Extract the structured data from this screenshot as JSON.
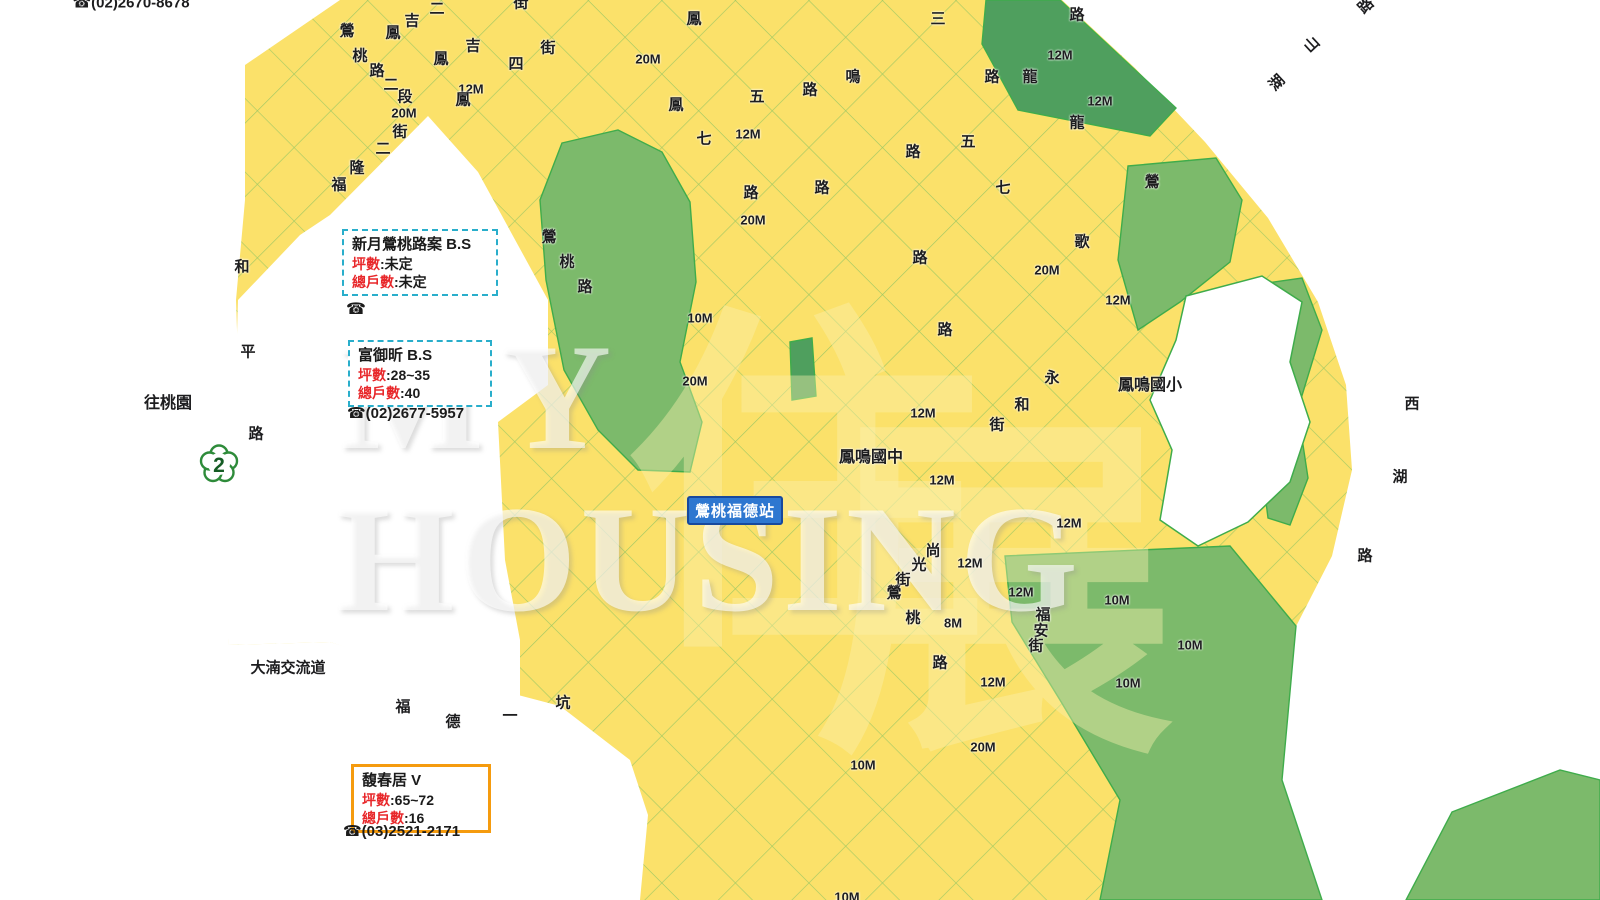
{
  "watermark": {
    "line1": "MY",
    "line2": "HOUSING",
    "cjk1": "住",
    "cjk2": "展"
  },
  "top_contact_phone": "☎(02)2670-8678",
  "projects": [
    {
      "name": "新月鶯桃路案 B.S",
      "fields": [
        {
          "label": "坪數",
          "value": "未定"
        },
        {
          "label": "總戶數",
          "value": "未定"
        }
      ],
      "phone": "☎"
    },
    {
      "name": "富御昕 B.S",
      "fields": [
        {
          "label": "坪數",
          "value": "28~35"
        },
        {
          "label": "總戶數",
          "value": "40"
        }
      ],
      "phone": "☎(02)2677-5957"
    },
    {
      "name": "馥春居 V",
      "fields": [
        {
          "label": "坪數",
          "value": "65~72"
        },
        {
          "label": "總戶數",
          "value": "16"
        }
      ],
      "phone": "☎(03)2521-2171"
    }
  ],
  "station": {
    "label": "鶯桃福德站"
  },
  "road_shield": {
    "number": "2"
  },
  "colors": {
    "residential_yellow": "#FBE16A",
    "park_green": "#7CBA6B",
    "dark_green": "#4F9F5E",
    "village_brown": "#8A7E6C",
    "commercial_red": "#DD5244",
    "school_salmon": "#EC8870",
    "pink": "#F3BDBB",
    "magenta": "#D63D9E",
    "lavender": "#C9C7E9",
    "teal_park": "#2AA678",
    "mrt_blue": "#2173D2",
    "planned_cyan": "#2FB7D8",
    "highway_orange": "#F59B0E",
    "railway_black": "#141414",
    "road_edge_green": "#3FAC4B",
    "station_blue": "#2E77D0",
    "info_red_text": "#E8282B",
    "highlight_road_yellow": "#EFF000"
  },
  "map_labels": [
    {
      "t": "☎(02)2670-8678",
      "x": 131,
      "y": 3,
      "s": 15,
      "n": "contact-phone-top"
    },
    {
      "t": "鶯",
      "x": 347,
      "y": 31
    },
    {
      "t": "桃",
      "x": 360,
      "y": 56
    },
    {
      "t": "路",
      "x": 377,
      "y": 71
    },
    {
      "t": "二",
      "x": 391,
      "y": 85
    },
    {
      "t": "段",
      "x": 405,
      "y": 97
    },
    {
      "t": "20M",
      "x": 404,
      "y": 113,
      "s": 13
    },
    {
      "t": "12M",
      "x": 471,
      "y": 89,
      "s": 13
    },
    {
      "t": "鳳",
      "x": 393,
      "y": 33
    },
    {
      "t": "吉",
      "x": 412,
      "y": 21
    },
    {
      "t": "二",
      "x": 437,
      "y": 9
    },
    {
      "t": "街",
      "x": 521,
      "y": 3
    },
    {
      "t": "鳳",
      "x": 441,
      "y": 59
    },
    {
      "t": "吉",
      "x": 473,
      "y": 46
    },
    {
      "t": "四",
      "x": 516,
      "y": 64
    },
    {
      "t": "街",
      "x": 548,
      "y": 48
    },
    {
      "t": "鳳",
      "x": 463,
      "y": 100
    },
    {
      "t": "福",
      "x": 339,
      "y": 185
    },
    {
      "t": "隆",
      "x": 357,
      "y": 168
    },
    {
      "t": "二",
      "x": 383,
      "y": 149
    },
    {
      "t": "街",
      "x": 400,
      "y": 132
    },
    {
      "t": "和",
      "x": 242,
      "y": 267
    },
    {
      "t": "平",
      "x": 248,
      "y": 352
    },
    {
      "t": "路",
      "x": 256,
      "y": 434
    },
    {
      "t": "往桃園",
      "x": 168,
      "y": 404,
      "s": 16,
      "n": "to-taoyuan-label"
    },
    {
      "t": "大湳交流道",
      "x": 288,
      "y": 668,
      "s": 15,
      "n": "danan-interchange-label"
    },
    {
      "t": "鳳",
      "x": 694,
      "y": 19
    },
    {
      "t": "五",
      "x": 757,
      "y": 97
    },
    {
      "t": "路",
      "x": 810,
      "y": 90
    },
    {
      "t": "鳳",
      "x": 676,
      "y": 105
    },
    {
      "t": "七",
      "x": 704,
      "y": 139
    },
    {
      "t": "路",
      "x": 751,
      "y": 193
    },
    {
      "t": "路",
      "x": 822,
      "y": 188
    },
    {
      "t": "20M",
      "x": 648,
      "y": 59,
      "s": 13
    },
    {
      "t": "12M",
      "x": 748,
      "y": 134,
      "s": 13
    },
    {
      "t": "鶯",
      "x": 549,
      "y": 237
    },
    {
      "t": "桃",
      "x": 567,
      "y": 262
    },
    {
      "t": "路",
      "x": 585,
      "y": 287
    },
    {
      "t": "20M",
      "x": 753,
      "y": 220,
      "s": 13
    },
    {
      "t": "10M",
      "x": 700,
      "y": 318,
      "s": 13
    },
    {
      "t": "20M",
      "x": 695,
      "y": 381,
      "s": 13
    },
    {
      "t": "鳴",
      "x": 853,
      "y": 77
    },
    {
      "t": "三",
      "x": 938,
      "y": 19
    },
    {
      "t": "路",
      "x": 1077,
      "y": 15
    },
    {
      "t": "路",
      "x": 992,
      "y": 77
    },
    {
      "t": "龍",
      "x": 1030,
      "y": 77
    },
    {
      "t": "五",
      "x": 968,
      "y": 142
    },
    {
      "t": "路",
      "x": 913,
      "y": 152
    },
    {
      "t": "七",
      "x": 1003,
      "y": 188
    },
    {
      "t": "龍",
      "x": 1077,
      "y": 123
    },
    {
      "t": "鶯",
      "x": 1152,
      "y": 182
    },
    {
      "t": "12M",
      "x": 1060,
      "y": 55,
      "s": 13
    },
    {
      "t": "12M",
      "x": 1100,
      "y": 101,
      "s": 13
    },
    {
      "t": "路",
      "x": 920,
      "y": 258
    },
    {
      "t": "歌",
      "x": 1082,
      "y": 242
    },
    {
      "t": "20M",
      "x": 1047,
      "y": 270,
      "s": 13
    },
    {
      "t": "12M",
      "x": 1118,
      "y": 300,
      "s": 13
    },
    {
      "t": "路",
      "x": 945,
      "y": 330
    },
    {
      "t": "湖",
      "x": 1277,
      "y": 83,
      "r": -43
    },
    {
      "t": "山",
      "x": 1312,
      "y": 45,
      "r": -43
    },
    {
      "t": "路",
      "x": 1366,
      "y": 6,
      "r": -43
    },
    {
      "t": "西",
      "x": 1412,
      "y": 404
    },
    {
      "t": "湖",
      "x": 1400,
      "y": 477
    },
    {
      "t": "路",
      "x": 1365,
      "y": 556
    },
    {
      "t": "永",
      "x": 1052,
      "y": 378
    },
    {
      "t": "和",
      "x": 1022,
      "y": 405
    },
    {
      "t": "街",
      "x": 997,
      "y": 425
    },
    {
      "t": "鳳鳴國小",
      "x": 1150,
      "y": 386,
      "s": 16,
      "n": "fengming-elementary-label"
    },
    {
      "t": "鳳鳴國中",
      "x": 871,
      "y": 458,
      "s": 16,
      "n": "fengming-junior-high-label"
    },
    {
      "t": "12M",
      "x": 923,
      "y": 413,
      "s": 13
    },
    {
      "t": "12M",
      "x": 942,
      "y": 480,
      "s": 13
    },
    {
      "t": "12M",
      "x": 1069,
      "y": 523,
      "s": 13
    },
    {
      "t": "12M",
      "x": 970,
      "y": 563,
      "s": 13
    },
    {
      "t": "8M",
      "x": 953,
      "y": 623,
      "s": 13
    },
    {
      "t": "12M",
      "x": 1021,
      "y": 592,
      "s": 13
    },
    {
      "t": "12M",
      "x": 993,
      "y": 682,
      "s": 13
    },
    {
      "t": "尚",
      "x": 933,
      "y": 551
    },
    {
      "t": "光",
      "x": 919,
      "y": 565
    },
    {
      "t": "街",
      "x": 903,
      "y": 580
    },
    {
      "t": "鶯",
      "x": 894,
      "y": 593
    },
    {
      "t": "桃",
      "x": 913,
      "y": 618
    },
    {
      "t": "路",
      "x": 940,
      "y": 663
    },
    {
      "t": "福",
      "x": 1043,
      "y": 615
    },
    {
      "t": "安",
      "x": 1041,
      "y": 631
    },
    {
      "t": "街",
      "x": 1036,
      "y": 646
    },
    {
      "t": "福",
      "x": 403,
      "y": 707
    },
    {
      "t": "德",
      "x": 453,
      "y": 722
    },
    {
      "t": "一",
      "x": 510,
      "y": 716
    },
    {
      "t": "坑",
      "x": 563,
      "y": 703
    },
    {
      "t": "10M",
      "x": 1117,
      "y": 600,
      "s": 13
    },
    {
      "t": "10M",
      "x": 1190,
      "y": 645,
      "s": 13
    },
    {
      "t": "10M",
      "x": 1128,
      "y": 683,
      "s": 13
    },
    {
      "t": "10M",
      "x": 863,
      "y": 765,
      "s": 13
    },
    {
      "t": "20M",
      "x": 983,
      "y": 747,
      "s": 13
    },
    {
      "t": "10M",
      "x": 847,
      "y": 897,
      "s": 13
    }
  ]
}
